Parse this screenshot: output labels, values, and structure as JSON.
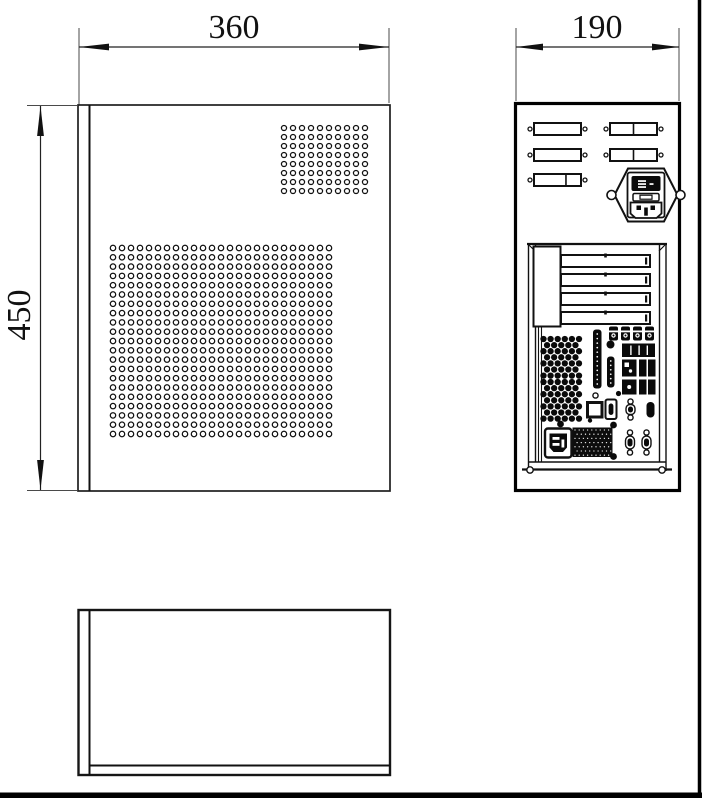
{
  "drawing": {
    "background": "#ffffff",
    "line_color": "#111111",
    "frame_color": "#000000"
  },
  "dimensions": {
    "side_width": {
      "label": "360",
      "value": 360,
      "unit": "mm"
    },
    "rear_width": {
      "label": "190",
      "value": 190,
      "unit": "mm"
    },
    "side_height": {
      "label": "450",
      "value": 450,
      "unit": "mm"
    }
  },
  "side_view": {
    "vent_grids": [
      {
        "name": "vent-grid-small",
        "x": 284,
        "y": 128,
        "cols": 10,
        "rows": 8,
        "dx": 9,
        "dy": 9,
        "r": 2.55
      },
      {
        "name": "vent-grid-large",
        "x": 113,
        "y": 248,
        "cols": 25,
        "rows": 21,
        "dx": 9,
        "dy": 9.3,
        "r": 2.7
      }
    ]
  },
  "rear_view": {
    "openings": {
      "w": 47,
      "h": 12,
      "screw_r": 2,
      "items": [
        {
          "x": 534,
          "y": 123,
          "divider": null
        },
        {
          "x": 534,
          "y": 149,
          "divider": null
        },
        {
          "x": 534,
          "y": 174,
          "divider": 0.68
        },
        {
          "x": 610,
          "y": 123,
          "divider": 0.5
        },
        {
          "x": 610,
          "y": 149,
          "divider": 0.5
        }
      ]
    },
    "expansion_slots": {
      "x": 561,
      "w": 89,
      "h": 12,
      "ys": [
        255,
        274,
        293,
        312
      ]
    },
    "fan_grilles": {
      "origins": [
        [
          543.5,
          339
        ],
        [
          543.5,
          382
        ]
      ],
      "cols": 6,
      "rows": 7,
      "dx": 7.1,
      "dy": 6.1,
      "r": 3.15,
      "row_offset": 3.55
    },
    "pin_strips": [
      {
        "x": 593,
        "y": 329.5,
        "w": 8.5,
        "h": 59,
        "dots": 12
      },
      {
        "x": 607,
        "y": 356.5,
        "w": 7.5,
        "h": 31,
        "dots": 6
      }
    ],
    "barrel_connectors": {
      "cxs": [
        613.5,
        625.5,
        637.5,
        649.5
      ],
      "y": 326.5,
      "w": 9,
      "h": 14
    },
    "psu_vent": {
      "x": 572.5,
      "y": 427.5,
      "w": 40,
      "h": 29.5,
      "dot_pitch": 4.2,
      "dot_r": 0.65
    }
  }
}
